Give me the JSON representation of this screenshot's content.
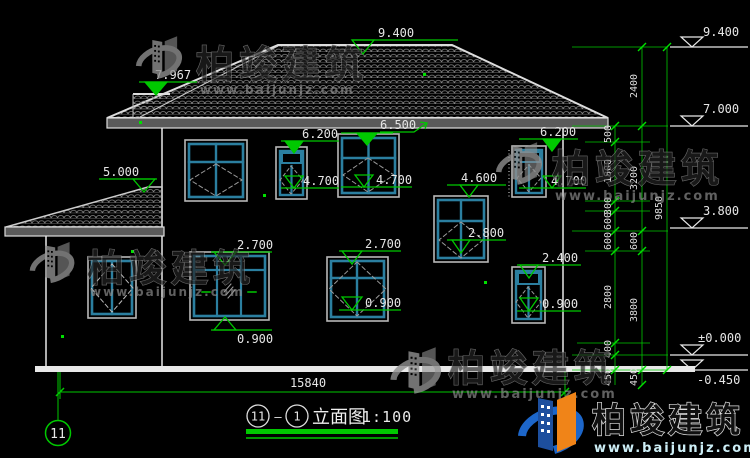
{
  "watermark": {
    "brand": "柏竣建筑",
    "url": "www.baijunjz.com"
  },
  "drawing": {
    "green_markers": [
      {
        "id": "ridge",
        "label": "9.400"
      },
      {
        "id": "left-upper-roof",
        "label": "7.967"
      },
      {
        "id": "porch-ridge",
        "label": "5.000"
      },
      {
        "id": "eave",
        "label": "6.500"
      },
      {
        "id": "win-b-head",
        "label": "6.200"
      },
      {
        "id": "win-e-head",
        "label": "6.200"
      },
      {
        "id": "win-b-sill",
        "label": "4.700"
      },
      {
        "id": "win-c-sill",
        "label": "4.700"
      },
      {
        "id": "win-e-sill",
        "label": "4.700"
      },
      {
        "id": "win-d-head",
        "label": "4.600"
      },
      {
        "id": "win-d-sill",
        "label": "2.800"
      },
      {
        "id": "win-f-head",
        "label": "2.700"
      },
      {
        "id": "win-g-head",
        "label": "2.700"
      },
      {
        "id": "win-f-sill",
        "label": "0.900"
      },
      {
        "id": "win-g-sill",
        "label": "0.900"
      },
      {
        "id": "win-i-head",
        "label": "2.400"
      },
      {
        "id": "win-i-sill",
        "label": "0.900"
      }
    ],
    "right_elevations": [
      {
        "label": "9.400"
      },
      {
        "label": "7.000"
      },
      {
        "label": "3.800"
      },
      {
        "label": "±0.000"
      },
      {
        "label": "-0.450"
      }
    ],
    "chains": {
      "inner": [
        "500",
        "1800",
        "300",
        "600",
        "600",
        "2800",
        "400",
        "450"
      ],
      "middle": [
        "2400",
        "3200",
        "600",
        "3800",
        "450"
      ],
      "total": "9850"
    },
    "ground_dim": "15840",
    "grid_bubble": "11"
  },
  "title": {
    "circle_left": "11",
    "dash": "—",
    "circle_right": "1",
    "text": "立面图",
    "scale": "1:100"
  }
}
